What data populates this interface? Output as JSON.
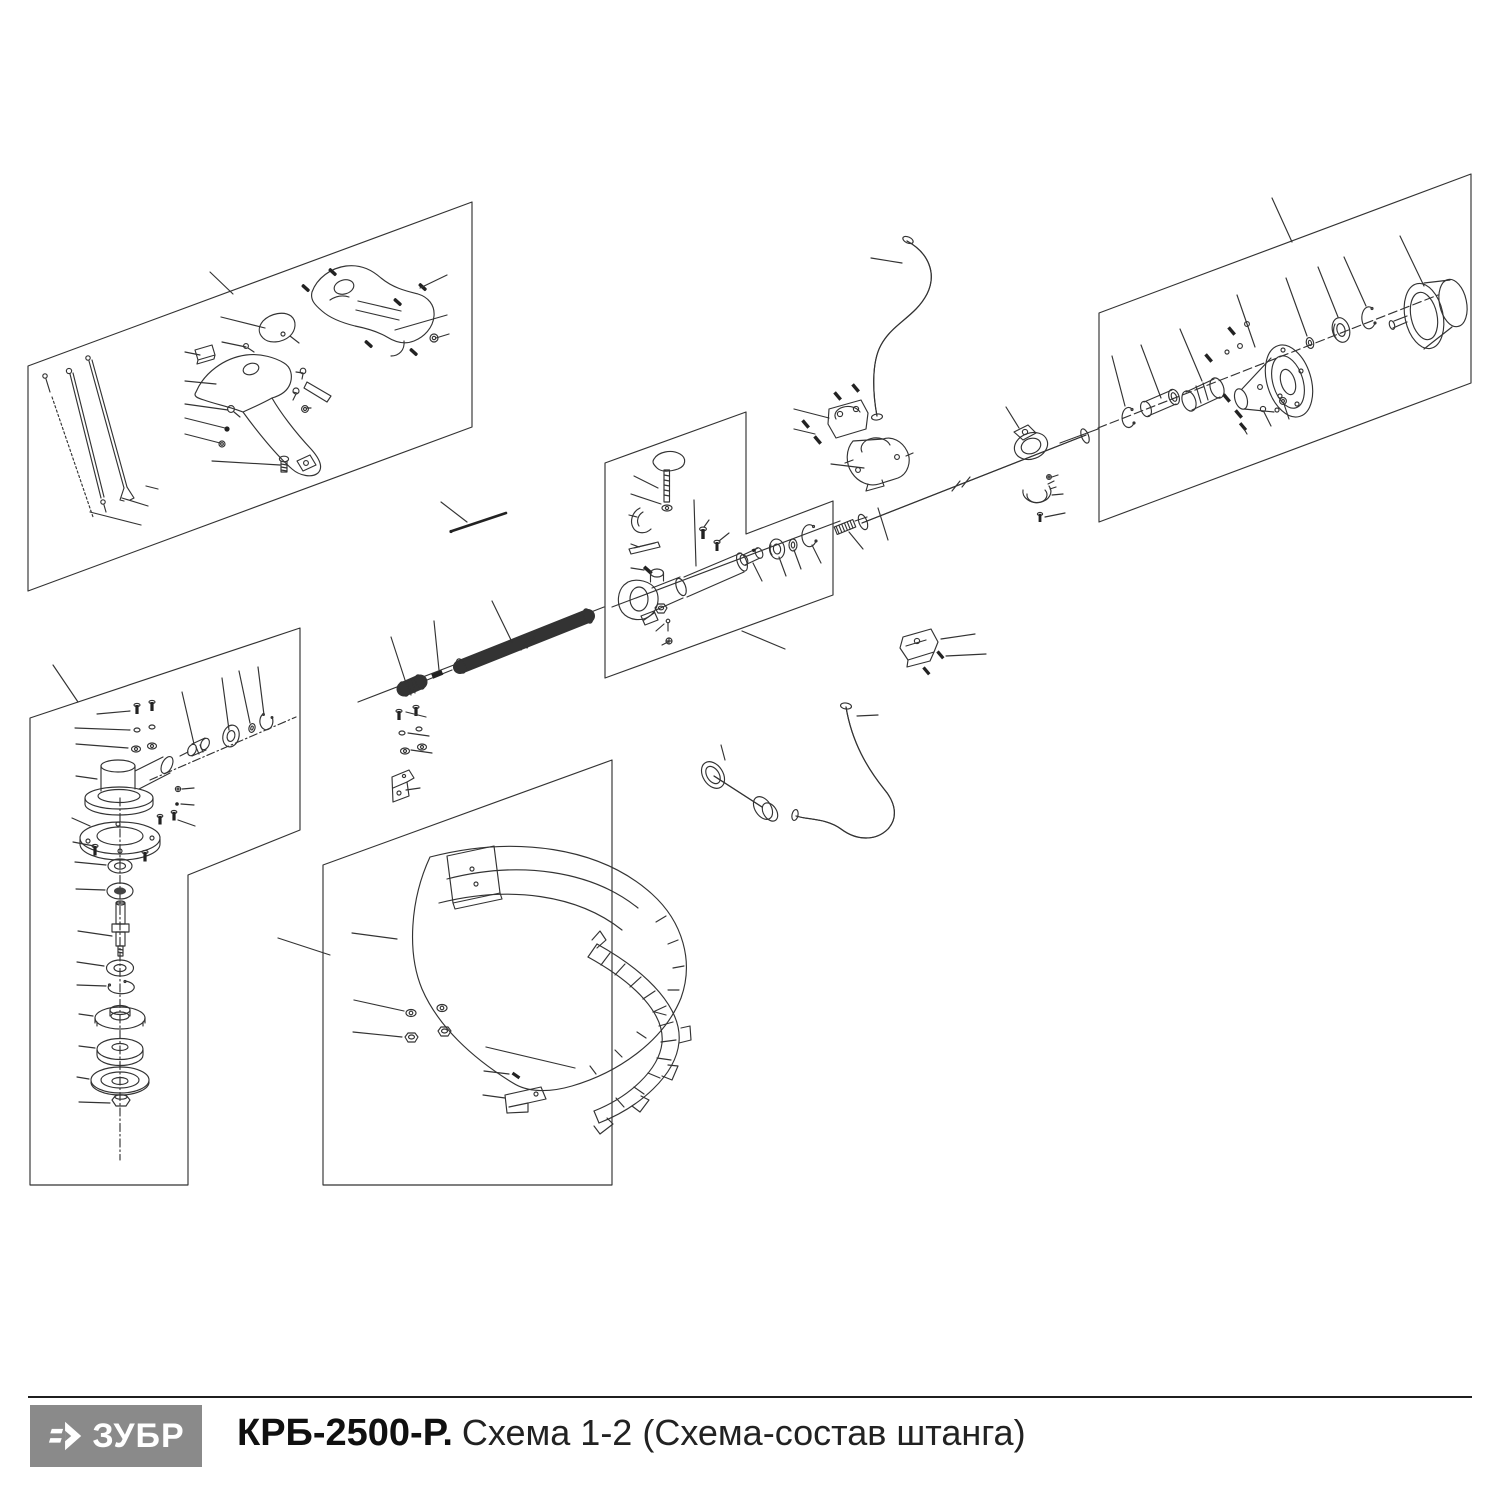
{
  "page": {
    "background": "#ffffff",
    "width": 1500,
    "height": 1500
  },
  "footer": {
    "divider_color": "#1f1f1f",
    "logo": {
      "text": "ЗУБР",
      "bg": "#8a8a8a",
      "fg": "#ffffff",
      "icon": "zubr-arrow-icon"
    },
    "title_model": "КРБ-2500-Р.",
    "title_scheme": "Схема 1-2 (Схема-состав штанга)"
  },
  "diagram": {
    "stroke": "#333333",
    "label_color": "#141414",
    "boxes": [
      {
        "name": "throttle-handle-assembly-46",
        "points": "28,366 472,202 472,427 28,591"
      },
      {
        "name": "gear-head-assembly-1",
        "points": "30,718 300,628 300,830 188,875 188,1185 30,1185"
      },
      {
        "name": "guard-assembly-24",
        "points": "323,865 612,760 612,1185 323,1185"
      },
      {
        "name": "coupler-assembly-90",
        "points": "605,463 746,412 746,534 833,501 833,595 605,678"
      },
      {
        "name": "clutch-assembly-64",
        "points": "1099,313 1471,174 1471,383 1099,522"
      }
    ],
    "labels": [
      [
        "46",
        198,
        266,
        210,
        272,
        233,
        294
      ],
      [
        "61",
        462,
        272,
        447,
        275,
        420,
        288
      ],
      [
        "57",
        208,
        315,
        221,
        317,
        265,
        328
      ],
      [
        "62",
        462,
        313,
        447,
        315,
        395,
        330
      ],
      [
        "56",
        209,
        341,
        222,
        342,
        246,
        347
      ],
      [
        "63",
        463,
        332,
        449,
        334,
        436,
        338
      ],
      [
        "55",
        172,
        350,
        185,
        352,
        200,
        355
      ],
      [
        "58",
        284,
        371,
        296,
        372,
        303,
        373
      ],
      [
        "54",
        172,
        380,
        185,
        381,
        216,
        384
      ],
      [
        "59",
        286,
        391,
        293,
        392,
        297,
        393
      ],
      [
        "53",
        172,
        403,
        185,
        404,
        228,
        410
      ],
      [
        "60",
        318,
        409,
        311,
        408,
        307,
        408
      ],
      [
        "52",
        172,
        417,
        185,
        418,
        225,
        428
      ],
      [
        "51",
        172,
        433,
        185,
        434,
        220,
        443
      ],
      [
        "50",
        198,
        459,
        212,
        461,
        280,
        465
      ],
      [
        "49",
        170,
        490,
        158,
        489,
        146,
        486
      ],
      [
        "48",
        160,
        508,
        148,
        506,
        122,
        498
      ],
      [
        "47",
        154,
        527,
        141,
        525,
        90,
        512
      ],
      [
        "40",
        436,
        495,
        441,
        502,
        467,
        522
      ],
      [
        "1",
        48,
        657,
        53,
        665,
        78,
        702
      ],
      [
        "16",
        85,
        713,
        97,
        714,
        130,
        711
      ],
      [
        "15",
        63,
        727,
        75,
        728,
        130,
        730
      ],
      [
        "14",
        64,
        743,
        76,
        744,
        128,
        748
      ],
      [
        "17",
        179,
        684,
        182,
        692,
        194,
        744
      ],
      [
        "18",
        219,
        670,
        222,
        678,
        229,
        730
      ],
      [
        "19",
        236,
        663,
        239,
        671,
        250,
        723
      ],
      [
        "20",
        255,
        659,
        258,
        667,
        264,
        715
      ],
      [
        "13",
        63,
        775,
        76,
        776,
        97,
        779
      ],
      [
        "21",
        206,
        788,
        194,
        788,
        182,
        789
      ],
      [
        "22",
        206,
        805,
        194,
        805,
        181,
        804
      ],
      [
        "12",
        59,
        817,
        72,
        818,
        90,
        826
      ],
      [
        "23",
        207,
        826,
        195,
        826,
        178,
        820
      ],
      [
        "11",
        61,
        841,
        73,
        842,
        94,
        846
      ],
      [
        "10",
        63,
        861,
        75,
        862,
        106,
        865
      ],
      [
        "9",
        64,
        888,
        76,
        889,
        105,
        890
      ],
      [
        "8",
        66,
        930,
        78,
        931,
        112,
        936
      ],
      [
        "7",
        65,
        961,
        77,
        962,
        104,
        966
      ],
      [
        "6",
        65,
        984,
        77,
        985,
        106,
        986
      ],
      [
        "5",
        67,
        1013,
        79,
        1014,
        93,
        1016
      ],
      [
        "4",
        67,
        1045,
        79,
        1046,
        95,
        1048
      ],
      [
        "3",
        65,
        1076,
        77,
        1077,
        89,
        1079
      ],
      [
        "2",
        67,
        1101,
        79,
        1102,
        110,
        1103
      ],
      [
        "24",
        266,
        935,
        278,
        938,
        330,
        955
      ],
      [
        "16",
        437,
        716,
        426,
        717,
        406,
        712
      ],
      [
        "15",
        440,
        735,
        429,
        736,
        408,
        733
      ],
      [
        "14",
        443,
        752,
        432,
        753,
        411,
        750
      ],
      [
        "31",
        433,
        787,
        420,
        788,
        406,
        790
      ],
      [
        "25",
        339,
        931,
        352,
        933,
        397,
        939
      ],
      [
        "26",
        341,
        998,
        354,
        1000,
        404,
        1011
      ],
      [
        "27",
        340,
        1030,
        353,
        1032,
        402,
        1037
      ],
      [
        "28",
        473,
        1044,
        486,
        1047,
        575,
        1068
      ],
      [
        "29",
        472,
        1070,
        484,
        1071,
        509,
        1074
      ],
      [
        "30",
        471,
        1094,
        483,
        1095,
        505,
        1098
      ],
      [
        "33",
        388,
        629,
        391,
        637,
        405,
        680
      ],
      [
        "34",
        431,
        613,
        434,
        621,
        439,
        670
      ],
      [
        "35",
        488,
        593,
        492,
        601,
        512,
        642
      ],
      [
        "81",
        622,
        473,
        634,
        476,
        658,
        488
      ],
      [
        "80",
        619,
        492,
        631,
        494,
        661,
        504
      ],
      [
        "82",
        693,
        490,
        694,
        500,
        696,
        566
      ],
      [
        "79",
        617,
        514,
        629,
        515,
        637,
        517
      ],
      [
        "83",
        712,
        513,
        709,
        520,
        704,
        527
      ],
      [
        "23",
        733,
        527,
        729,
        533,
        719,
        541
      ],
      [
        "78",
        619,
        543,
        631,
        544,
        639,
        547
      ],
      [
        "77",
        619,
        567,
        631,
        568,
        644,
        570
      ],
      [
        "76",
        633,
        623,
        644,
        620,
        654,
        613
      ],
      [
        "75",
        646,
        634,
        656,
        631,
        664,
        624
      ],
      [
        "74",
        652,
        648,
        662,
        645,
        668,
        642
      ],
      [
        "84",
        764,
        588,
        762,
        581,
        753,
        563
      ],
      [
        "85",
        788,
        583,
        786,
        576,
        779,
        557
      ],
      [
        "86",
        803,
        576,
        801,
        569,
        794,
        550
      ],
      [
        "87",
        823,
        570,
        821,
        563,
        812,
        545
      ],
      [
        "88",
        868,
        556,
        863,
        549,
        849,
        532
      ],
      [
        "89",
        893,
        547,
        888,
        540,
        878,
        508
      ],
      [
        "90",
        796,
        653,
        785,
        649,
        742,
        631
      ],
      [
        "43",
        858,
        256,
        871,
        258,
        902,
        263
      ],
      [
        "42",
        782,
        406,
        794,
        409,
        829,
        418
      ],
      [
        "32",
        782,
        427,
        794,
        429,
        815,
        434
      ],
      [
        "41",
        819,
        462,
        831,
        464,
        864,
        468
      ],
      [
        "45",
        1002,
        399,
        1006,
        407,
        1019,
        428
      ],
      [
        "27",
        1070,
        474,
        1058,
        475,
        1052,
        477
      ],
      [
        "44",
        1075,
        493,
        1063,
        494,
        1052,
        495
      ],
      [
        "32",
        1077,
        512,
        1065,
        513,
        1045,
        517
      ],
      [
        "37",
        890,
        714,
        878,
        715,
        857,
        716
      ],
      [
        "36",
        719,
        737,
        721,
        745,
        725,
        760
      ],
      [
        "39",
        987,
        633,
        975,
        634,
        941,
        639
      ],
      [
        "38",
        998,
        653,
        986,
        654,
        946,
        656
      ],
      [
        "64",
        1268,
        190,
        1272,
        198,
        1292,
        242
      ],
      [
        "72",
        1396,
        228,
        1400,
        236,
        1424,
        286
      ],
      [
        "71",
        1341,
        249,
        1344,
        257,
        1366,
        306
      ],
      [
        "70",
        1315,
        259,
        1318,
        267,
        1338,
        317
      ],
      [
        "69",
        1283,
        270,
        1286,
        278,
        1307,
        336
      ],
      [
        "68",
        1234,
        287,
        1237,
        295,
        1255,
        347
      ],
      [
        "67",
        1177,
        321,
        1180,
        329,
        1202,
        381
      ],
      [
        "66",
        1138,
        337,
        1141,
        345,
        1161,
        398
      ],
      [
        "65",
        1110,
        348,
        1112,
        356,
        1125,
        406
      ],
      [
        "73",
        1249,
        441,
        1247,
        434,
        1244,
        429
      ],
      [
        "15",
        1274,
        433,
        1271,
        426,
        1264,
        412
      ],
      [
        "14",
        1292,
        426,
        1289,
        419,
        1284,
        404
      ]
    ]
  }
}
